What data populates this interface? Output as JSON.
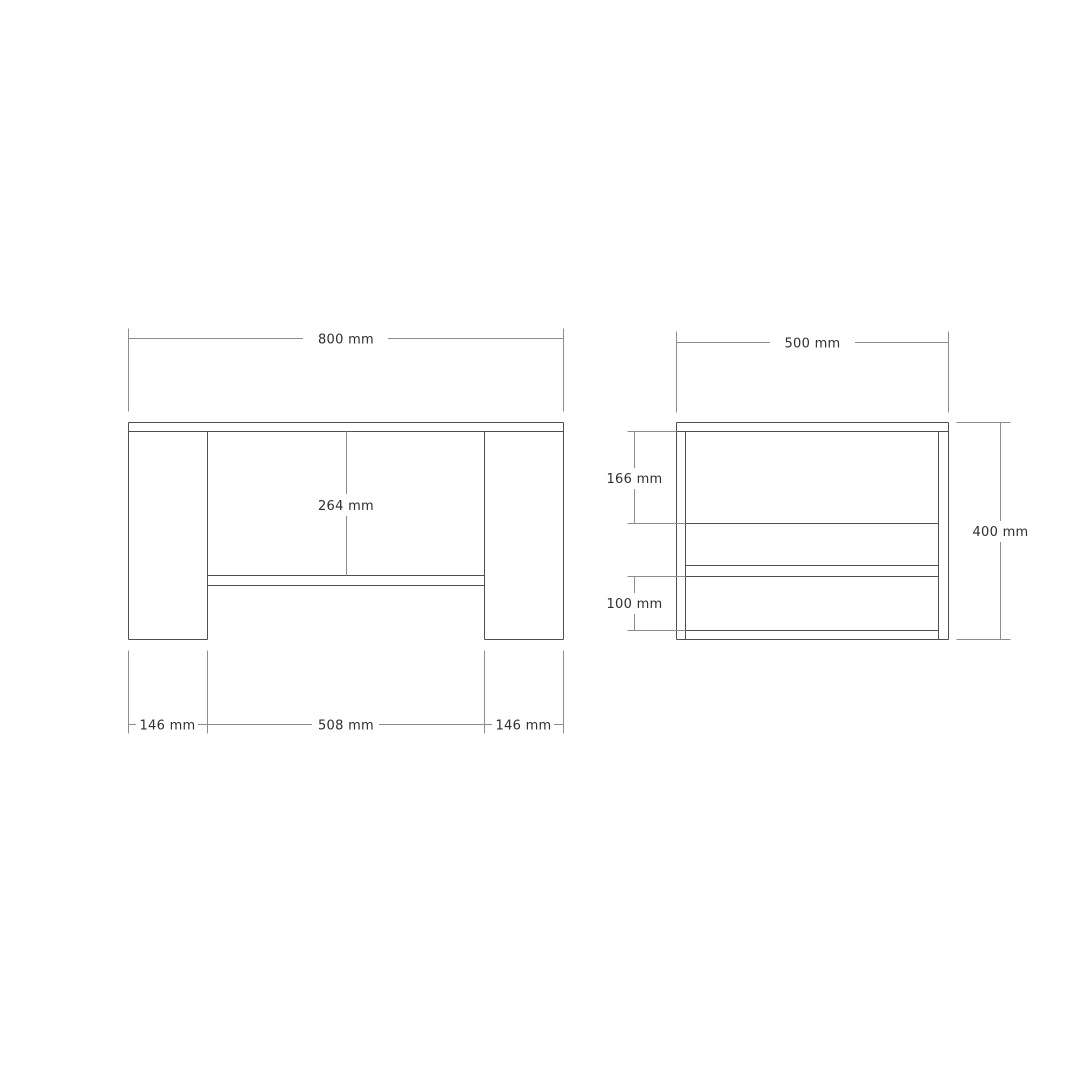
{
  "drawing": {
    "type": "furniture-dimension-drawing",
    "units": "mm",
    "front_view": {
      "width": "800 mm",
      "interior_height": "264 mm",
      "left_leg_width": "146 mm",
      "opening_width": "508 mm",
      "right_leg_width": "146 mm"
    },
    "side_view": {
      "depth": "500 mm",
      "upper_shelf_gap": "166 mm",
      "lower_shelf_gap": "100 mm",
      "height": "400 mm"
    },
    "colors": {
      "object_line": "#4f4f4f",
      "dimension_line": "#8d8d8d",
      "label_text": "#2f2f2f",
      "background": "#ffffff"
    }
  }
}
